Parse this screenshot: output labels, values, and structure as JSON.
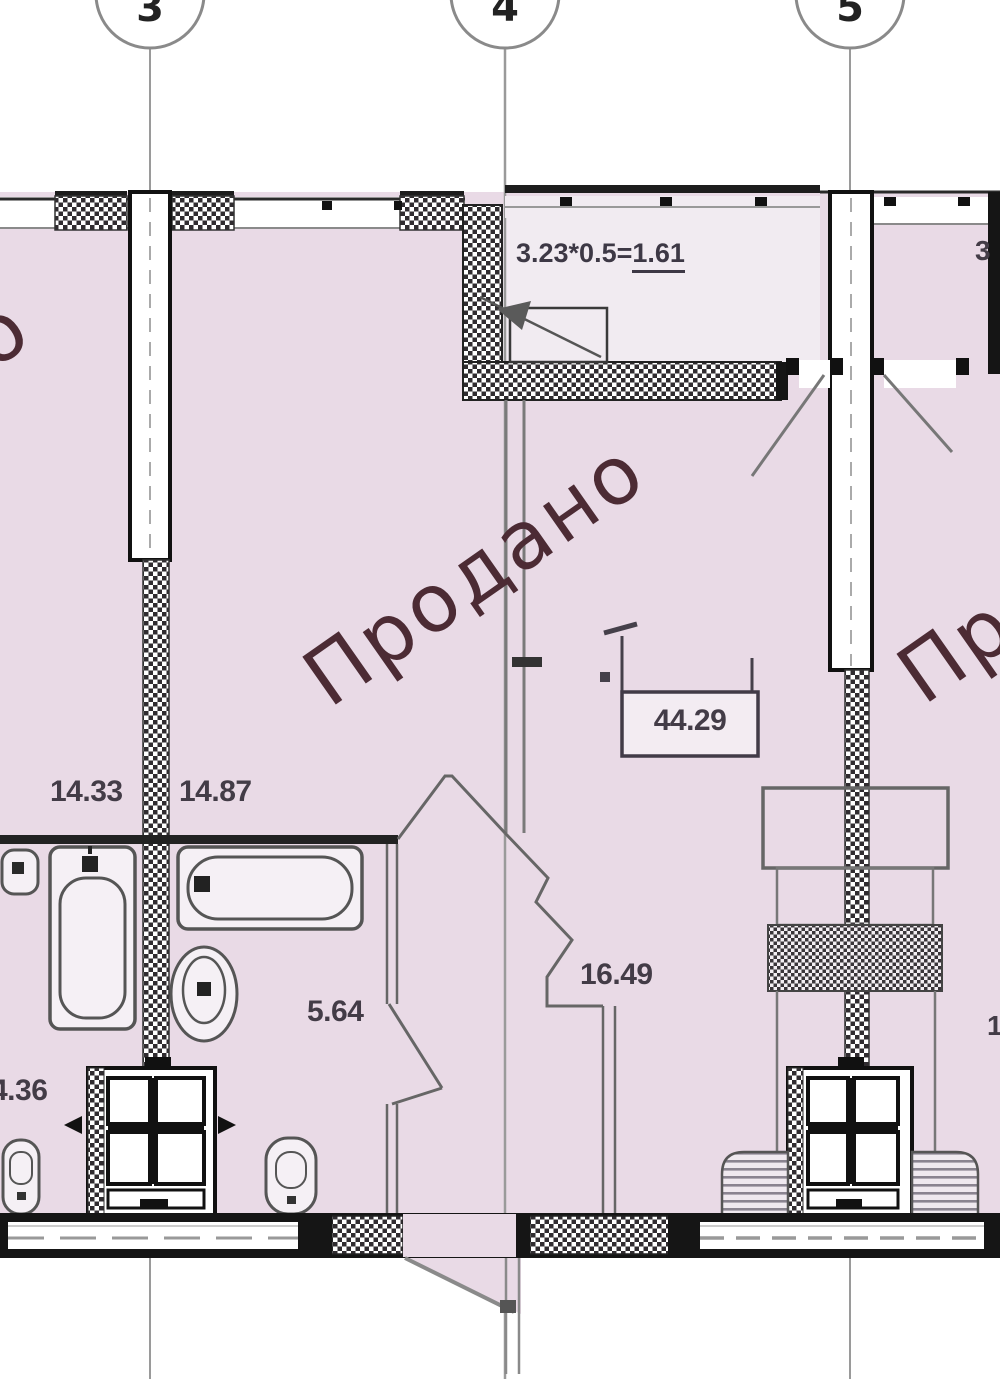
{
  "drawing": {
    "axis_labels": [
      "3",
      "4",
      "5"
    ],
    "sold_stamp": "Продано",
    "sold_stamp_partial_left": "о",
    "balcony_formula": {
      "expression": "3.23*0.5=",
      "result": "1.61"
    },
    "balcony_formula_partial_right": "3",
    "areas": {
      "room_left": "14.33",
      "room_right": "14.87",
      "hallway": "5.64",
      "living_room": "16.49",
      "bathroom": "4.36",
      "total_area": "44.29",
      "partial_right_bottom": "1"
    },
    "colors": {
      "plan_fill": "#e9dae6",
      "landing_fill": "#f1ebf1",
      "stamp": "#4c2b34",
      "wall_line": "#1a1a1a",
      "label_text": "#433c47"
    }
  }
}
